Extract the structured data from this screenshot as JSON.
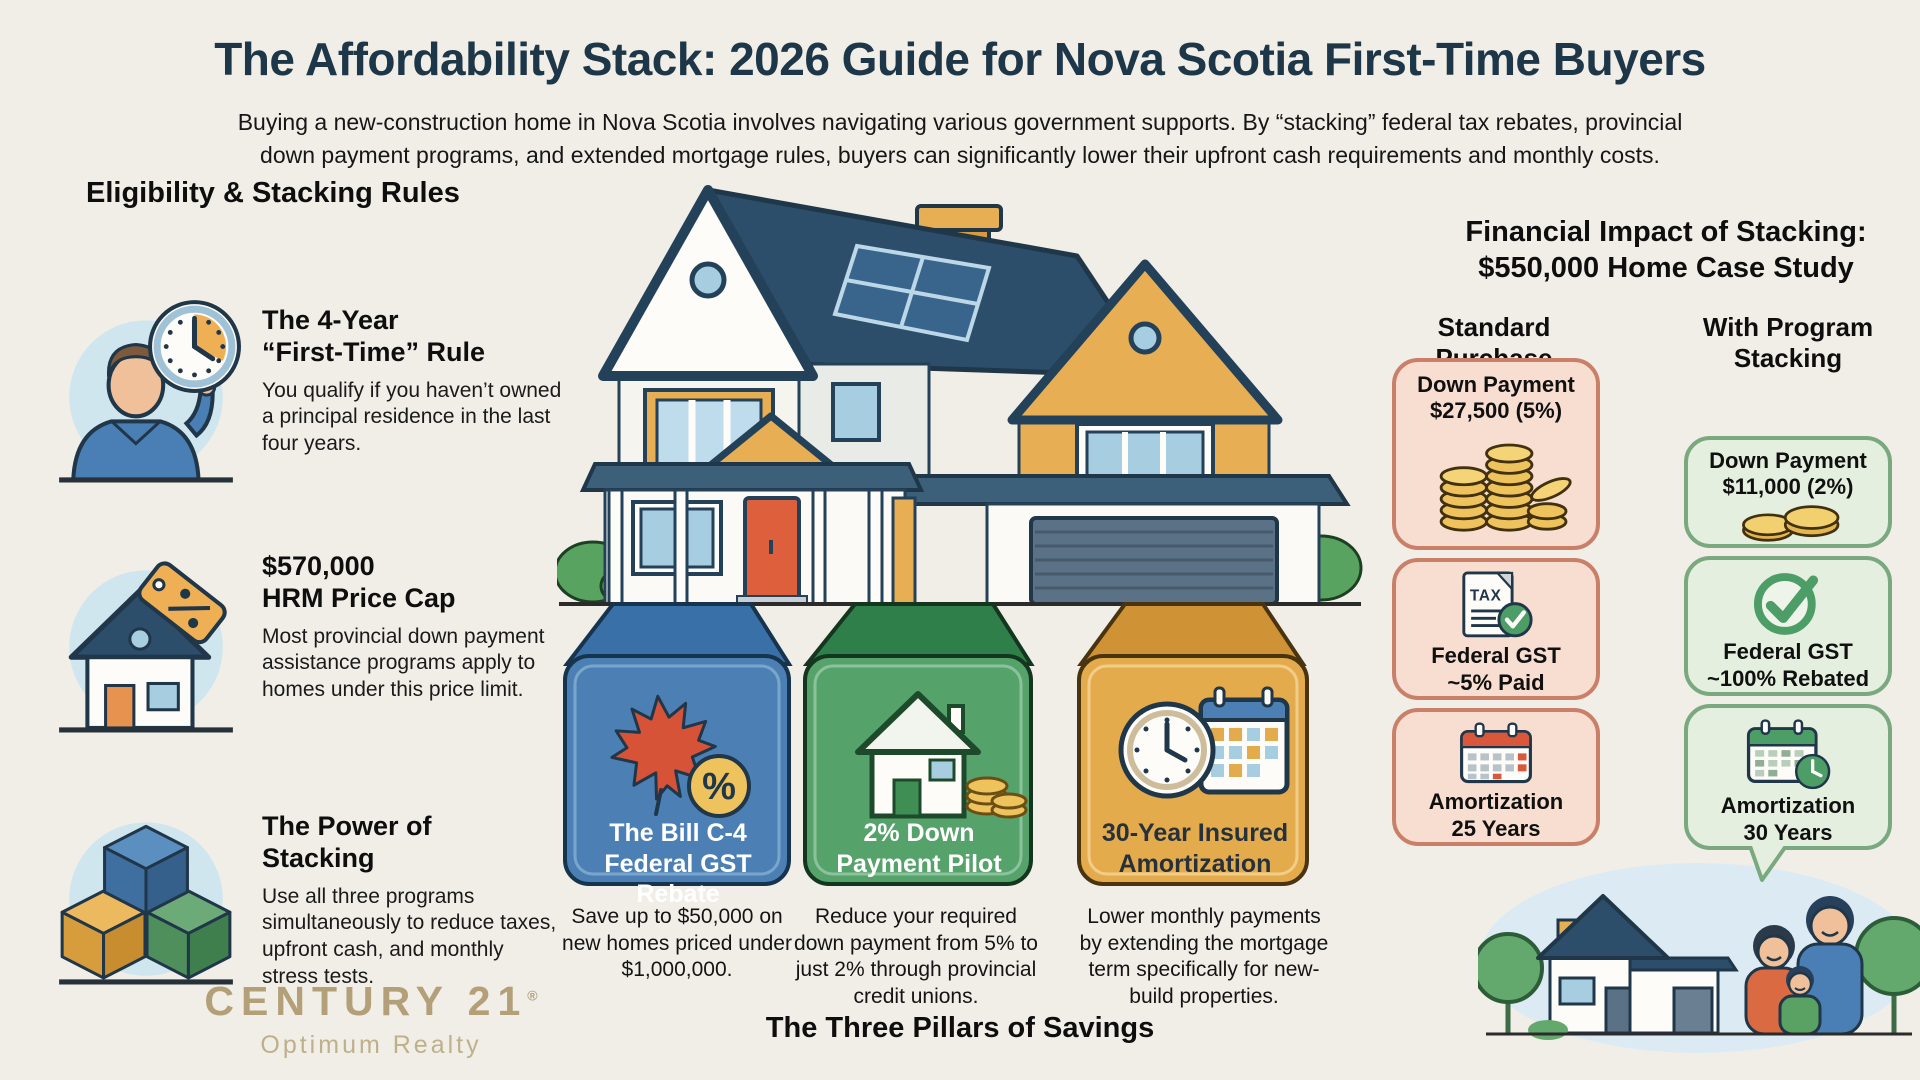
{
  "header": {
    "title": "The Affordability Stack: 2026 Guide for Nova Scotia First-Time Buyers",
    "subtitle": "Buying a new-construction home in Nova Scotia involves navigating various government supports. By “stacking” federal tax rebates, provincial\ndown payment programs, and extended mortgage rules, buyers can significantly lower their upfront cash requirements and monthly costs."
  },
  "eligibility": {
    "heading": "Eligibility & Stacking Rules",
    "items": [
      {
        "icon": "person-clock-icon",
        "title": "The 4-Year\n“First-Time” Rule",
        "body": "You qualify if you haven’t owned a principal residence in the last four years."
      },
      {
        "icon": "house-price-tag-icon",
        "title": "$570,000\nHRM Price Cap",
        "body": "Most provincial down payment assistance programs apply to homes under this price limit."
      },
      {
        "icon": "stacked-cubes-icon",
        "title": "The Power of\nStacking",
        "body": "Use all three programs simultaneously to reduce taxes, upfront cash, and monthly stress tests."
      }
    ]
  },
  "brand": {
    "name": "CENTURY 21",
    "registered": "®",
    "subtitle": "Optimum Realty",
    "color": "#b3a078"
  },
  "pillars": {
    "caption": "The Three Pillars of Savings",
    "items": [
      {
        "icon": "maple-leaf-percent-icon",
        "color": "#4c80b4",
        "label": "The Bill C-4\nFederal GST Rebate",
        "description": "Save up to $50,000 on new homes priced under $1,000,000."
      },
      {
        "icon": "house-coins-icon",
        "color": "#56a26b",
        "label": "2% Down\nPayment Pilot",
        "description": "Reduce your required down payment from 5% to just 2% through provincial credit unions."
      },
      {
        "icon": "clock-calendar-icon",
        "color": "#e4ab4d",
        "label": "30-Year Insured\nAmortization",
        "description": "Lower monthly payments by extending the mortgage term specifically for new-build properties."
      }
    ]
  },
  "impact": {
    "heading": "Financial Impact of Stacking:\n$550,000 Home Case Study",
    "standard": {
      "heading": "Standard Purchase",
      "accent": "#ca8068",
      "cards": [
        {
          "icon": "coin-stacks-icon",
          "label": "Down Payment\n$27,500 (5%)"
        },
        {
          "icon": "tax-document-check-icon",
          "label": "Federal GST\n~5% Paid"
        },
        {
          "icon": "calendar-red-icon",
          "label": "Amortization\n25 Years"
        }
      ]
    },
    "stacking": {
      "heading": "With Program\nStacking",
      "accent": "#7aa87f",
      "cards": [
        {
          "icon": "two-coins-icon",
          "label": "Down Payment\n$11,000 (2%)"
        },
        {
          "icon": "check-circle-icon",
          "label": "Federal GST\n~100% Rebated"
        },
        {
          "icon": "calendar-clock-icon",
          "label": "Amortization\n30 Years"
        }
      ]
    }
  }
}
